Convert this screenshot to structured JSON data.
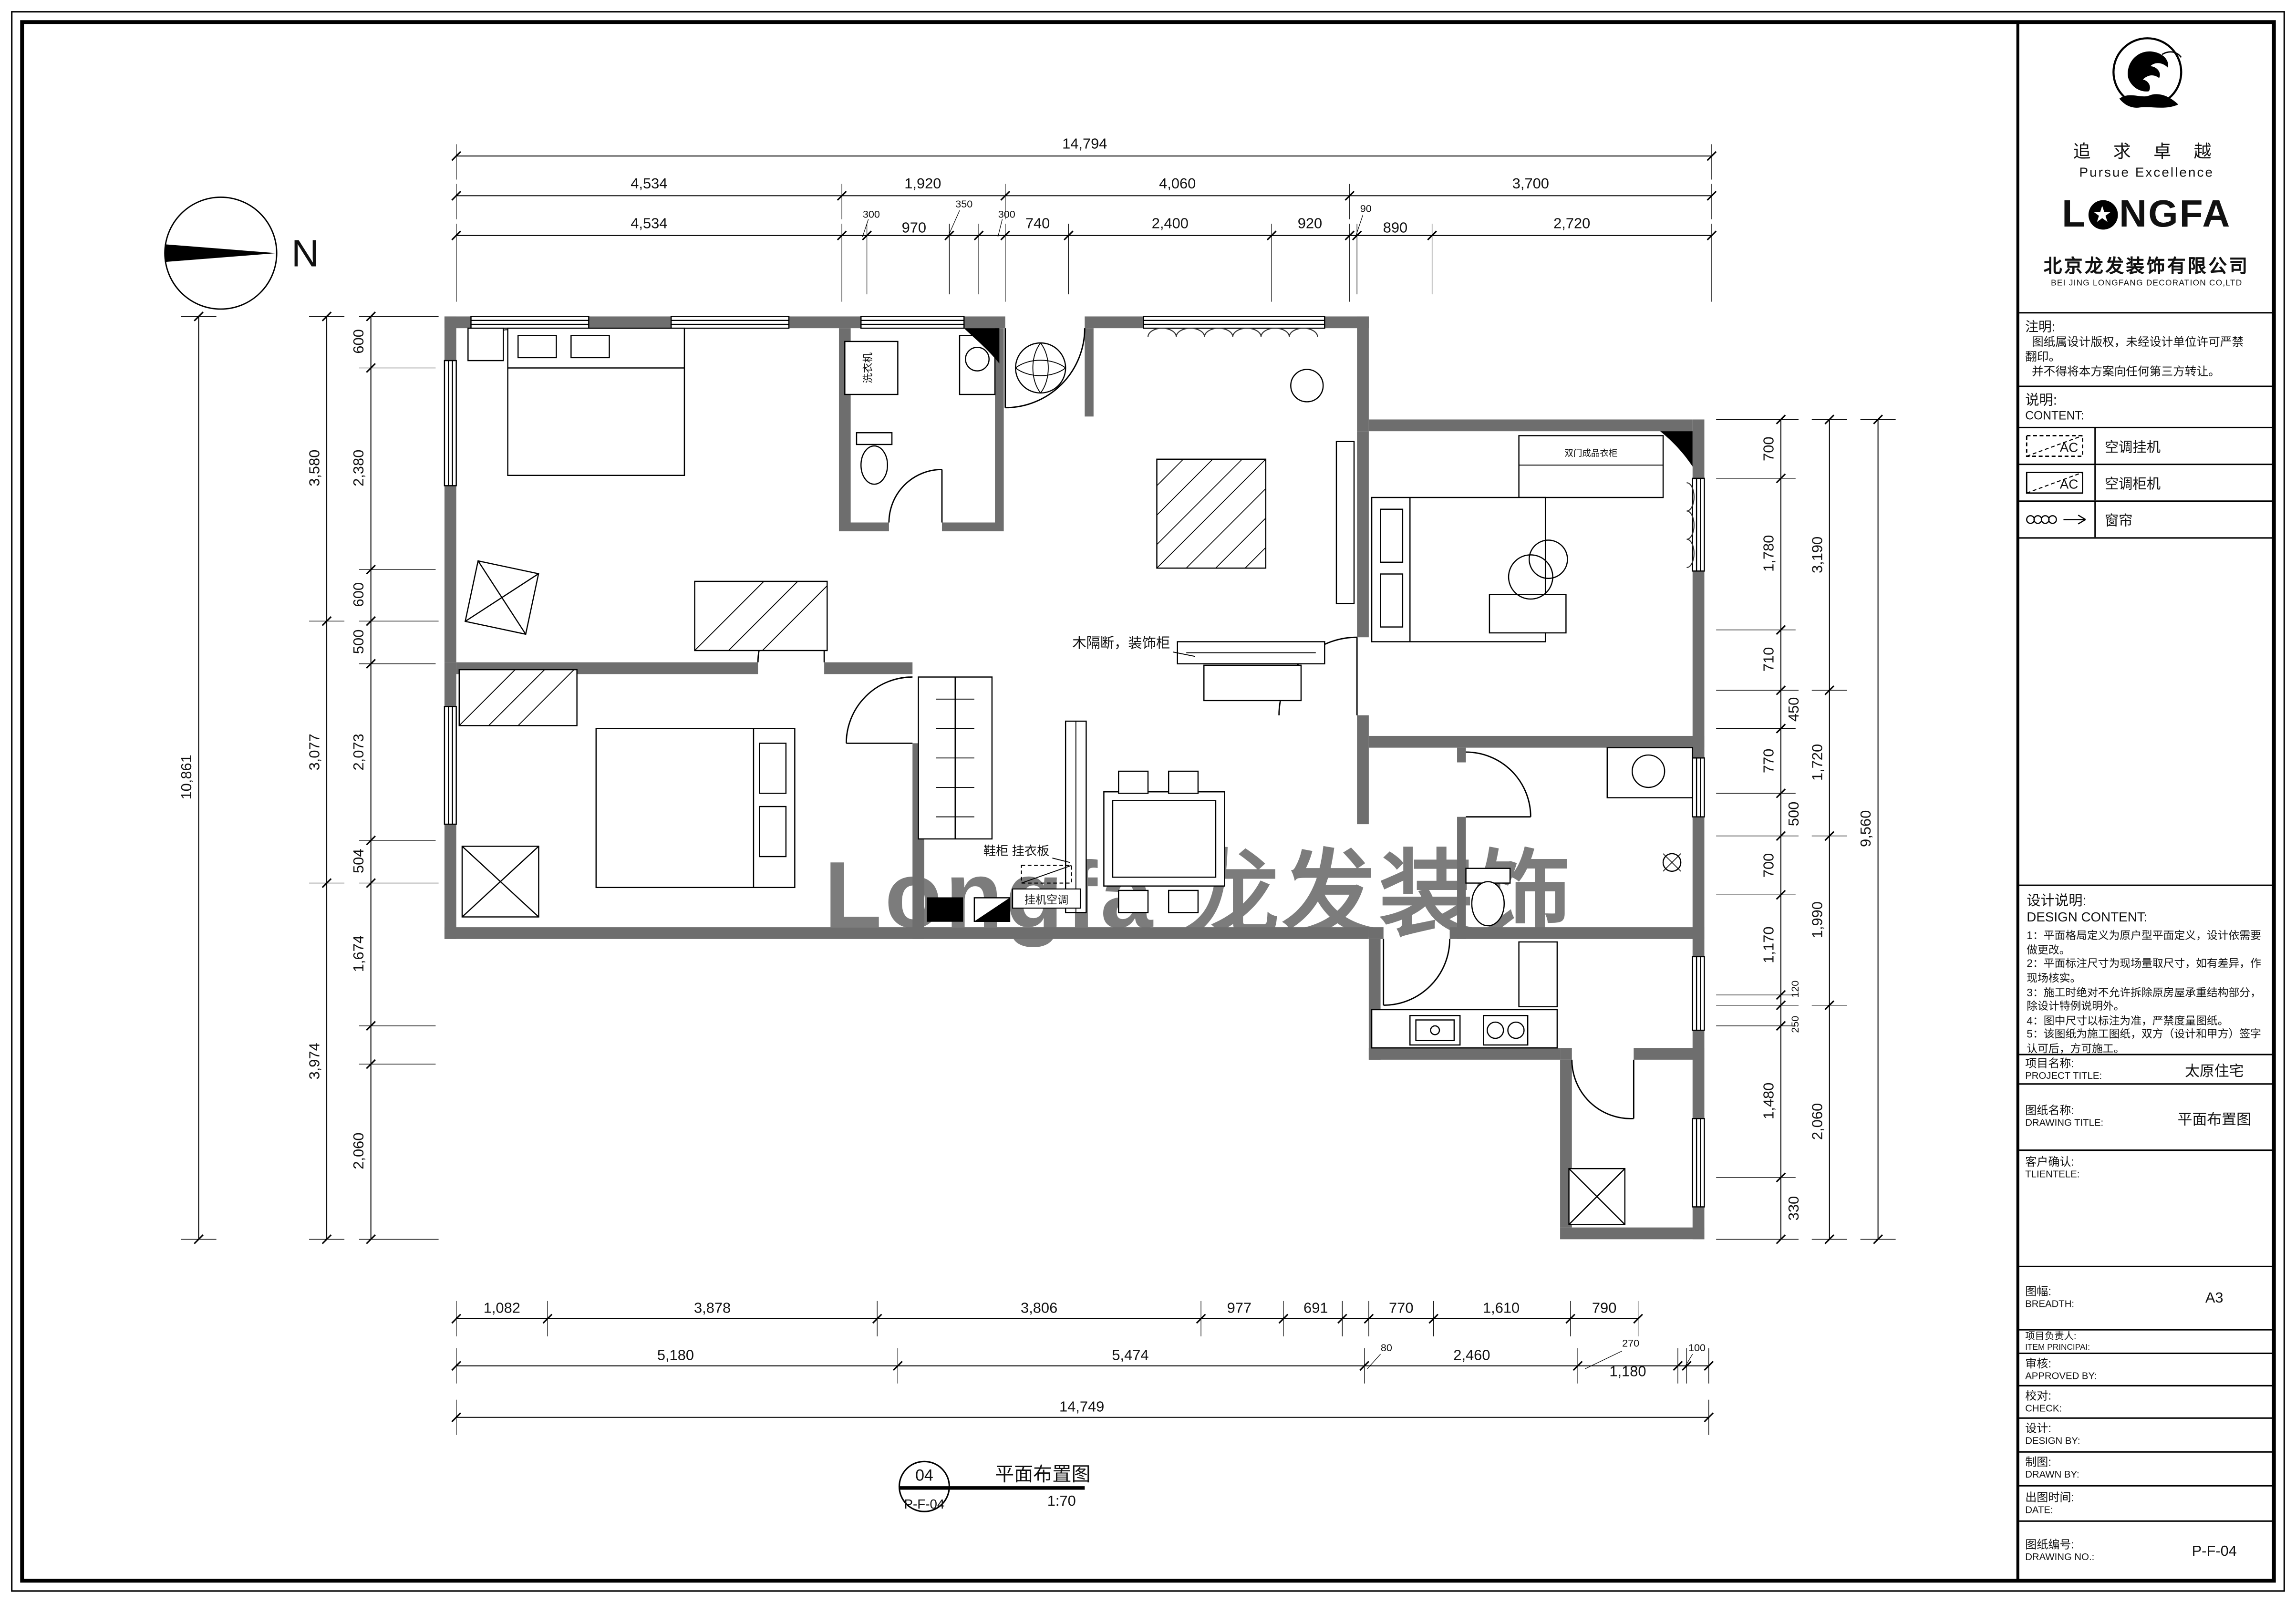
{
  "compass": {
    "label": "N"
  },
  "watermark": {
    "text": "Longfa 龙发装饰"
  },
  "figure": {
    "number": "04",
    "code": "P-F-04",
    "title": "平面布置图",
    "scale": "1:70"
  },
  "company": {
    "motto_cn": "追 求 卓 越",
    "motto_en": "Pursue Excellence",
    "brand_l": "L",
    "brand_star": "★",
    "brand_rest": "NGFA",
    "name_cn": "北京龙发装饰有限公司",
    "name_en": "BEI JING LONGFANG DECORATION CO,LTD"
  },
  "titleblock": {
    "note_label": "注明:",
    "note_lines": [
      "  图纸属设计版权，未经设计单位许可严禁",
      "翻印。",
      "  并不得将本方案向任何第三方转让。"
    ],
    "content_label_cn": "说明:",
    "content_label_en": "CONTENT:",
    "legend": [
      {
        "symbol": "ac-hang-unit-icon",
        "ac_text": "AC",
        "label": "空调挂机"
      },
      {
        "symbol": "ac-cabinet-unit-icon",
        "ac_text": "AC",
        "label": "空调柜机"
      },
      {
        "symbol": "curtain-icon",
        "ac_text": "",
        "label": "窗帘"
      }
    ],
    "design_label_cn": "设计说明:",
    "design_label_en": "DESIGN CONTENT:",
    "design_notes": [
      "1：平面格局定义为原户型平面定义，设计依需要做更改。",
      "2：平面标注尺寸为现场量取尺寸，如有差异，作现场核实。",
      "3：施工时绝对不允许拆除原房屋承重结构部分，除设计特例说明外。",
      "4：图中尺寸以标注为准，严禁度量图纸。",
      "5：该图纸为施工图纸，双方（设计和甲方）签字认可后，方可施工。"
    ],
    "rows": [
      {
        "cn": "项目名称:",
        "en": "PROJECT TITLE:",
        "value": "太原住宅"
      },
      {
        "cn": "图纸名称:",
        "en": "DRAWING TITLE:",
        "value": "平面布置图"
      },
      {
        "cn": "客户确认:",
        "en": "TLIENTELE:",
        "value": ""
      },
      {
        "cn": "图幅:",
        "en": "BREADTH:",
        "value": "A3"
      },
      {
        "cn": "项目负责人:",
        "en": "ITEM PRINCIPAI:",
        "value": ""
      },
      {
        "cn": "审核:",
        "en": "APPROVED BY:",
        "value": ""
      },
      {
        "cn": "校对:",
        "en": "CHECK:",
        "value": ""
      },
      {
        "cn": "设计:",
        "en": "DESIGN BY:",
        "value": ""
      },
      {
        "cn": "制图:",
        "en": "DRAWN BY:",
        "value": ""
      },
      {
        "cn": "出图时间:",
        "en": "DATE:",
        "value": ""
      },
      {
        "cn": "图纸编号:",
        "en": "DRAWING NO.:",
        "value": "P-F-04"
      }
    ]
  },
  "plan": {
    "partition_label": "木隔断，装饰柜",
    "shoe_label": "鞋柜 挂衣板",
    "ac_label": "挂机空调",
    "washer_label": "洗衣机",
    "wardrobe_label": "双门成品衣柜"
  },
  "dimensions": {
    "top": {
      "total": "14,794",
      "row2": [
        "4,534",
        "1,920",
        "4,060",
        "3,700"
      ],
      "row3": [
        "4,534",
        "300",
        "970",
        "350",
        "300",
        "740",
        "2,400",
        "920",
        "90",
        "890",
        "2,720"
      ]
    },
    "left": {
      "outer": "10,861",
      "mid": [
        "3,580",
        "3,077",
        "3,974"
      ],
      "inner": [
        "600",
        "2,380",
        "600",
        "500",
        "2,073",
        "504",
        "1,674",
        "2,060"
      ]
    },
    "right": {
      "outer": "9,560",
      "mid": [
        "3,190",
        "1,720",
        "1,990",
        "2,060"
      ],
      "inner": [
        "700",
        "1,780",
        "710",
        "450",
        "770",
        "500",
        "700",
        "1,170",
        "120",
        "250",
        "1,480",
        "330"
      ]
    },
    "bottom": {
      "row1": [
        "1,082",
        "3,878",
        "3,806",
        "977",
        "691",
        "770",
        "1,610",
        "790"
      ],
      "row2": [
        "5,180",
        "5,474",
        "80",
        "2,460",
        "270",
        "1,180",
        "100"
      ],
      "total": "14,749"
    }
  }
}
